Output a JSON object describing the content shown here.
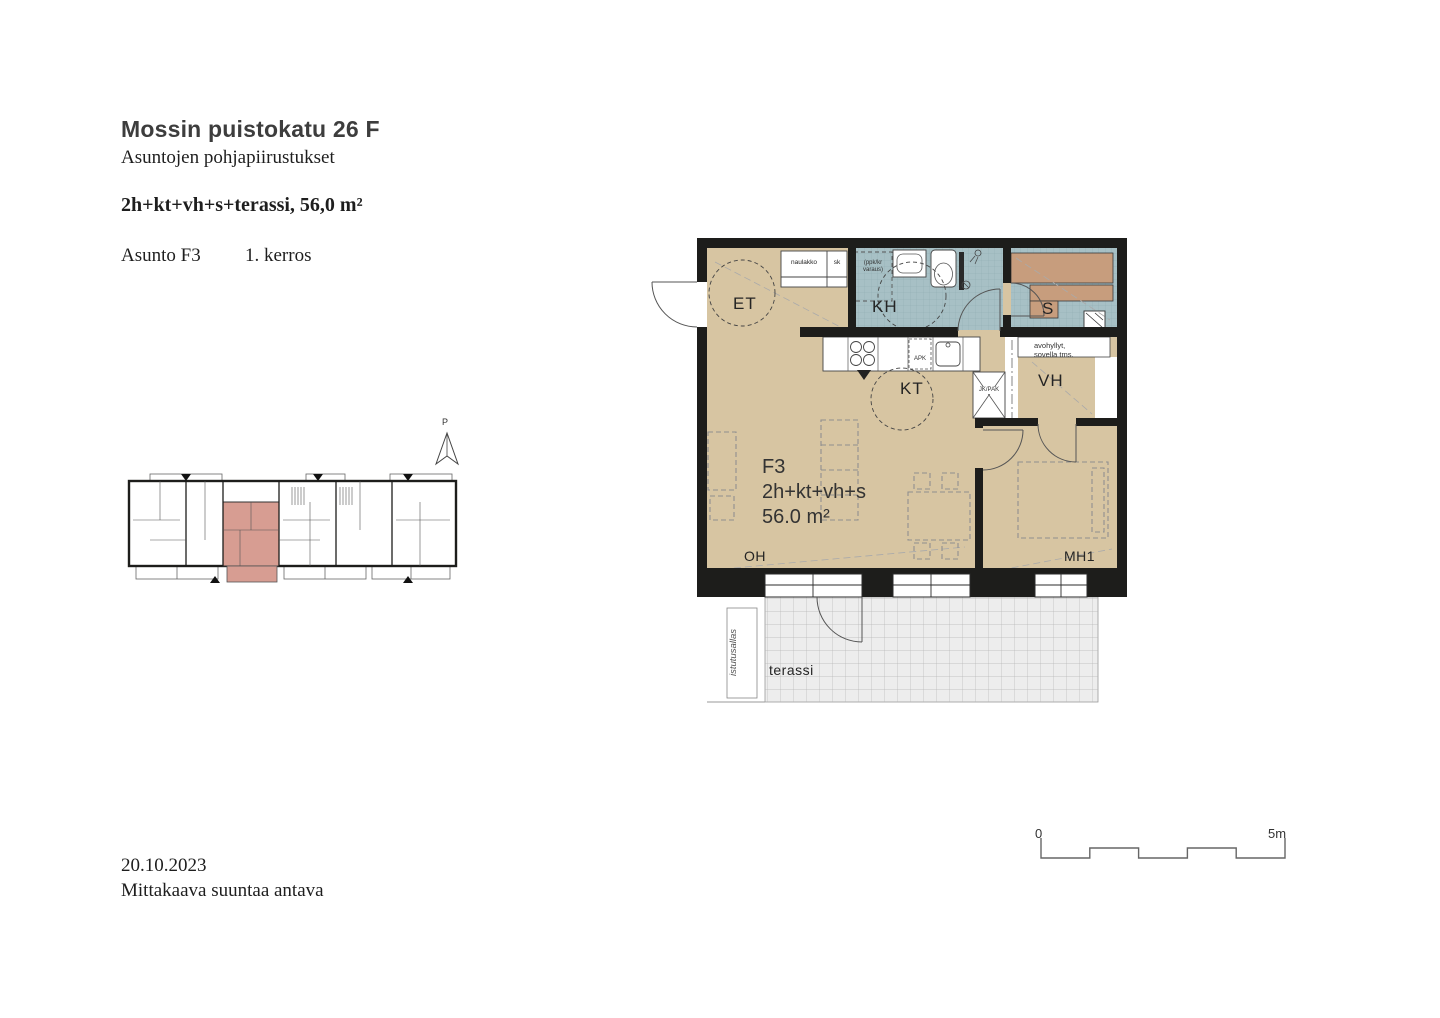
{
  "header": {
    "title": "Mossin puistokatu 26 F",
    "subtitle": "Asuntojen pohjapiirustukset",
    "type_line": "2h+kt+vh+s+terassi, 56,0 m²",
    "unit_label": "Asunto F3",
    "floor_label": "1. kerros"
  },
  "plan": {
    "unit_id": "F3",
    "unit_type": "2h+kt+vh+s",
    "unit_area": "56.0 m²",
    "rooms": {
      "entry": "ET",
      "bathroom": "KH",
      "sauna": "S",
      "kitchen": "KT",
      "closet": "VH",
      "living": "OH",
      "bedroom": "MH1",
      "terrace": "terassi"
    },
    "annotations": {
      "coat_rack": "naulakko",
      "cleaning_closet": "sk",
      "washer_line1": "(ppk/kr",
      "washer_line2": "varaus)",
      "shelves_line1": "avohyllyt,",
      "shelves_line2": "sovella tms.",
      "fridge": "JK/PAK",
      "dishwasher": "APK",
      "planter": "istutusallas"
    }
  },
  "overview": {
    "north_label": "P"
  },
  "footer": {
    "date": "20.10.2023",
    "note": "Mittakaava suuntaa antava"
  },
  "scale_bar": {
    "start": "0",
    "end": "5m"
  },
  "colors": {
    "floor": "#d7c5a2",
    "tile": "#a7c0c5",
    "bench": "#c79d7d",
    "wall": "#1d1d1b",
    "highlight": "#d79d92",
    "terrace": "#ededed"
  }
}
